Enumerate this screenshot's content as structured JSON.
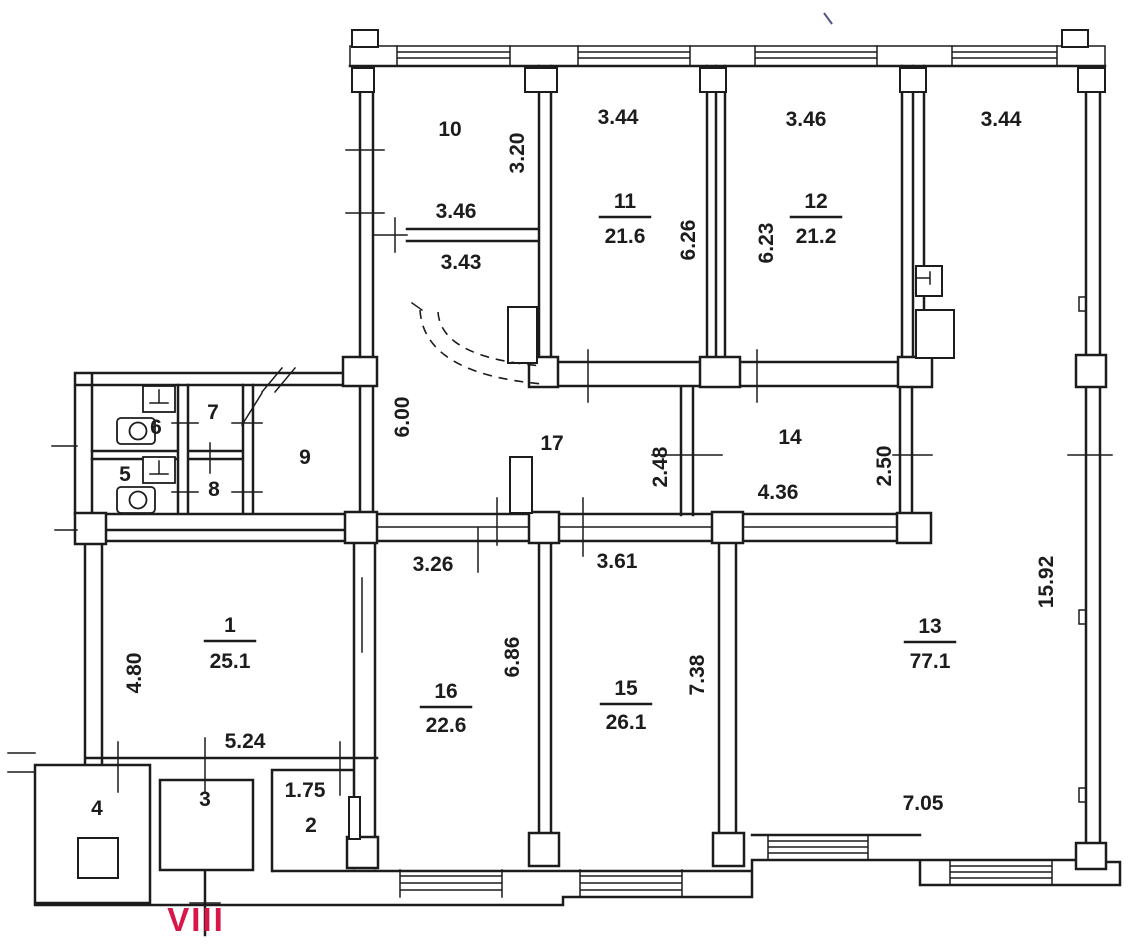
{
  "floorplan": {
    "section_label": "VIII",
    "colors": {
      "line": "#1c1c1c",
      "accent": "#d81648",
      "dim_muted": "#8f8f8f",
      "room9_gray": "#6e6e6e",
      "mark_blue": "#55558c"
    },
    "rooms": {
      "r1": {
        "num": "1",
        "area": "25.1"
      },
      "r2": {
        "num": "2"
      },
      "r3": {
        "num": "3"
      },
      "r4": {
        "num": "4"
      },
      "r5": {
        "num": "5"
      },
      "r6": {
        "num": "6"
      },
      "r7": {
        "num": "7"
      },
      "r8": {
        "num": "8"
      },
      "r9": {
        "num": "9"
      },
      "r10": {
        "num": "10"
      },
      "r11": {
        "num": "11",
        "area": "21.6"
      },
      "r12": {
        "num": "12",
        "area": "21.2"
      },
      "r13": {
        "num": "13",
        "area": "77.1"
      },
      "r14": {
        "num": "14"
      },
      "r15": {
        "num": "15",
        "area": "26.1"
      },
      "r16": {
        "num": "16",
        "area": "22.6"
      },
      "r17": {
        "num": "17"
      }
    },
    "dims": {
      "top_11": "3.44",
      "top_12": "3.46",
      "top_13": "3.44",
      "r10_h": "3.20",
      "r10_w1": "3.46",
      "r10_w2": "3.43",
      "r11_h": "6.26",
      "r12_h": "6.23",
      "right_h": "15.92",
      "corr_h": "6.00",
      "corr_w": "2.48",
      "r14_w": "4.36",
      "r14_h": "2.50",
      "r16_top": "3.26",
      "r15_top": "3.61",
      "r1_h": "4.80",
      "r1_w": "5.24",
      "r16_h": "6.86",
      "r15_h": "7.38",
      "r13_w": "7.05",
      "r2_w": "1.75"
    }
  }
}
